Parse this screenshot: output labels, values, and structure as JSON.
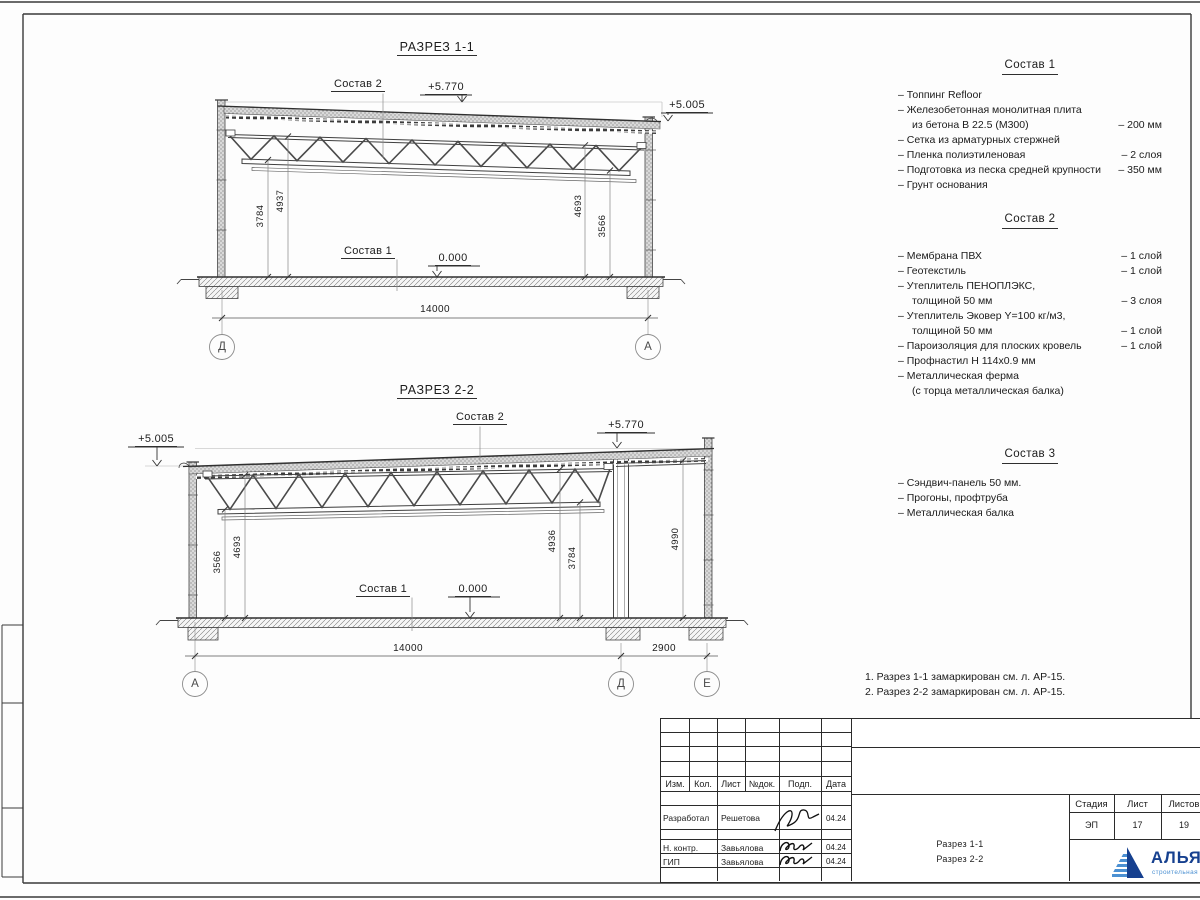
{
  "section1": {
    "title": "РАЗРЕЗ 1-1",
    "label_sostav2": "Состав 2",
    "label_sostav1": "Состав 1",
    "elev_top": "+5.770",
    "elev_right": "+5.005",
    "elev_floor": "0.000",
    "dim_left_inner": "3784",
    "dim_left_outer": "4937",
    "dim_right_outer": "4693",
    "dim_right_inner": "3566",
    "dim_span": "14000",
    "grid_left": "Д",
    "grid_right": "А"
  },
  "section2": {
    "title": "РАЗРЕЗ 2-2",
    "label_sostav2": "Состав 2",
    "label_sostav1": "Состав 1",
    "elev_top": "+5.770",
    "elev_left": "+5.005",
    "elev_floor": "0.000",
    "dim_l_outer": "3566",
    "dim_l_inner": "4693",
    "dim_m_inner": "4936",
    "dim_m_outer": "3784",
    "dim_bay": "4990",
    "dim_span": "14000",
    "dim_span2": "2900",
    "grid_a": "А",
    "grid_d": "Д",
    "grid_e": "Е"
  },
  "sostav1": {
    "title": "Состав 1",
    "items": [
      {
        "l1": "– Топпинг Refloor"
      },
      {
        "l1": "– Железобетонная  монолитная плита",
        "l2": "из бетона В 22.5 (М300)",
        "v": "– 200 мм"
      },
      {
        "l1": "– Сетка из арматурных стержней"
      },
      {
        "l1": "– Пленка полиэтиленовая",
        "v": "– 2 слоя"
      },
      {
        "l1": "– Подготовка из песка средней крупности",
        "v": "– 350 мм"
      },
      {
        "l1": "– Грунт основания"
      }
    ]
  },
  "sostav2": {
    "title": "Состав 2",
    "items": [
      {
        "l1": "– Мембрана ПВХ",
        "v": "– 1 слой"
      },
      {
        "l1": "– Геотекстиль",
        "v": "– 1 слой"
      },
      {
        "l1": "– Утеплитель ПЕНОПЛЭКС,",
        "l2": "толщиной 50 мм",
        "v": "– 3 слоя"
      },
      {
        "l1": "– Утеплитель Эковер Y=100 кг/м3,",
        "l2": "толщиной 50 мм",
        "v": "– 1 слой"
      },
      {
        "l1": "– Пароизоляция для плоских кровель",
        "v": "– 1 слой"
      },
      {
        "l1": "– Профнастил Н 114х0.9 мм"
      },
      {
        "l1": "– Металлическая ферма",
        "l2": "(с торца металлическая балка)"
      }
    ]
  },
  "sostav3": {
    "title": "Состав 3",
    "items": [
      {
        "l1": "– Сэндвич-панель 50 мм."
      },
      {
        "l1": "– Прогоны, профтруба"
      },
      {
        "l1": "– Металлическая балка"
      }
    ]
  },
  "notes": {
    "n1": "1. Разрез 1-1 замаркирован см. л. АР-15.",
    "n2": "2. Разрез 2-2 замаркирован см. л. АР-15."
  },
  "titleblock": {
    "col_izm": "Изм.",
    "col_kol": "Кол.",
    "col_list": "Лист",
    "col_ndok": "№док.",
    "col_podp": "Подп.",
    "col_data": "Дата",
    "row1_role": "Разработал",
    "row1_name": "Решетова",
    "row1_date": "04.24",
    "row2_role": "Н. контр.",
    "row2_name": "Завьялова",
    "row2_date": "04.24",
    "row3_role": "ГИП",
    "row3_name": "Завьялова",
    "row3_date": "04.24",
    "doc_line1": "Разрез 1-1",
    "doc_line2": "Разрез 2-2",
    "stadia_label": "Стадия",
    "list_label": "Лист",
    "listov_label": "Листов",
    "stadia_value": "ЭП",
    "list_value": "17",
    "listov_value": "19"
  },
  "logo": {
    "name": "АЛЬЯНС",
    "subtitle": "строительная компания",
    "brand_dark": "#16408f",
    "brand_light": "#4b90d2"
  }
}
